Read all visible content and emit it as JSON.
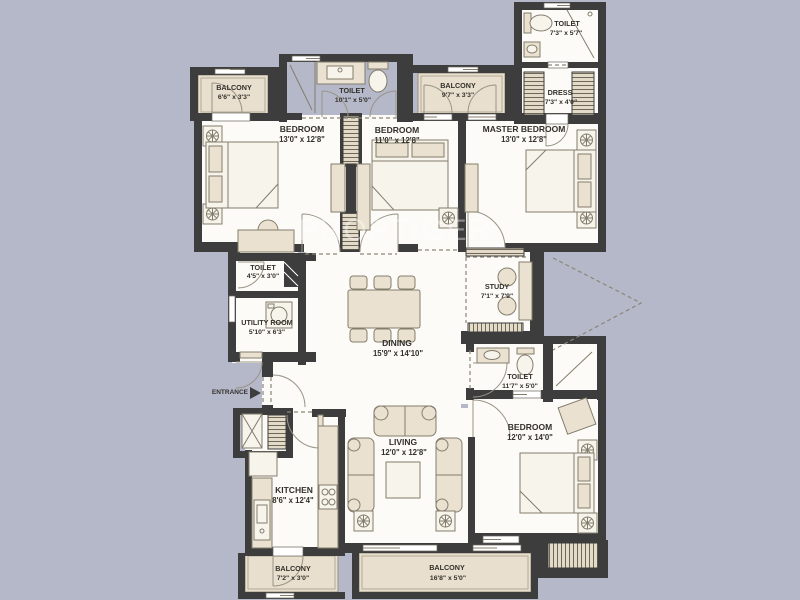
{
  "colors": {
    "background": "#b4b8c9",
    "wall": "#3d3d3d",
    "floor": "#fcfbf7",
    "balcony": "#e8dfce",
    "furniture": "#eae1d0",
    "label": "#33302a",
    "watermark": "#ffffff"
  },
  "watermark": "PROPTIGER",
  "entrance_label": "ENTRANCE",
  "rooms": [
    {
      "id": "balcony_top_left",
      "name": "BALCONY",
      "dims": "6'6\" x 3'3\""
    },
    {
      "id": "toilet_top",
      "name": "TOILET",
      "dims": "10'1\" x 5'0\""
    },
    {
      "id": "balcony_top_mid",
      "name": "BALCONY",
      "dims": "9'7\" x 3'3\""
    },
    {
      "id": "toilet_top_right",
      "name": "TOILET",
      "dims": "7'3\" x 5'7\""
    },
    {
      "id": "dress",
      "name": "DRESS",
      "dims": "7'3\" x 4'0\""
    },
    {
      "id": "bedroom_1",
      "name": "BEDROOM",
      "dims": "13'0\" x 12'8\""
    },
    {
      "id": "bedroom_2",
      "name": "BEDROOM",
      "dims": "11'0\" x 12'8\""
    },
    {
      "id": "master_bedroom",
      "name": "MASTER BEDROOM",
      "dims": "13'0\" x 12'8\""
    },
    {
      "id": "toilet_mid_left",
      "name": "TOILET",
      "dims": "4'5\" x 3'0\""
    },
    {
      "id": "utility_room",
      "name": "UTILITY ROOM",
      "dims": "5'10\" x 6'3\""
    },
    {
      "id": "dining",
      "name": "DINING",
      "dims": "15'9\" x 14'10\""
    },
    {
      "id": "study",
      "name": "STUDY",
      "dims": "7'1\" x 7'9\""
    },
    {
      "id": "toilet_mid_right",
      "name": "TOILET",
      "dims": "11'7\" x 5'0\""
    },
    {
      "id": "kitchen",
      "name": "KITCHEN",
      "dims": "8'6\" x 12'4\""
    },
    {
      "id": "living",
      "name": "LIVING",
      "dims": "12'0\" x 12'8\""
    },
    {
      "id": "bedroom_3",
      "name": "BEDROOM",
      "dims": "12'0\" x 14'0\""
    },
    {
      "id": "balcony_bot_left",
      "name": "BALCONY",
      "dims": "7'2\" x 3'0\""
    },
    {
      "id": "balcony_bot_mid",
      "name": "BALCONY",
      "dims": "16'8\" x 5'0\""
    }
  ]
}
